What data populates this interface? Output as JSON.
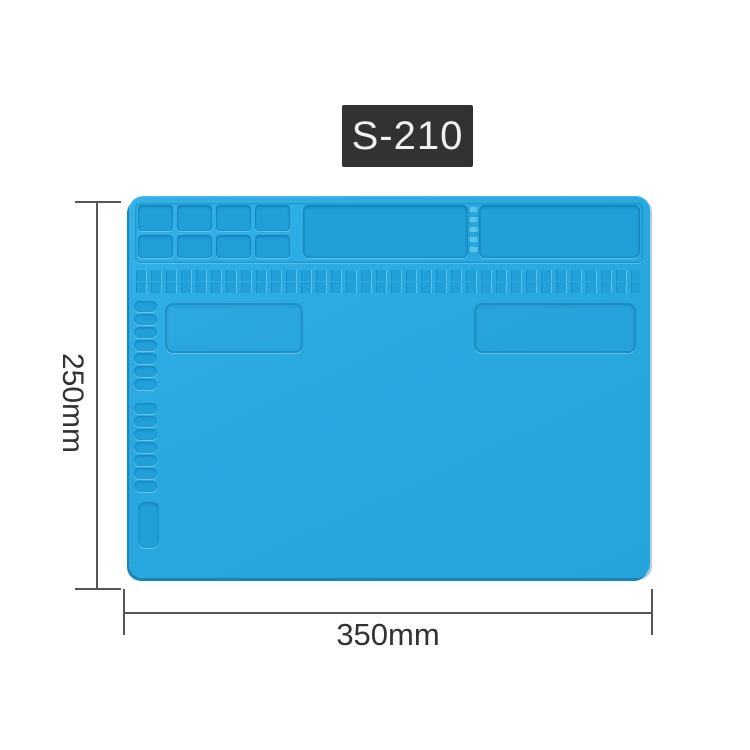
{
  "product": {
    "model_label": "S-210"
  },
  "dimensions": {
    "height_label": "250mm",
    "width_label": "350mm"
  },
  "colors": {
    "mat-surface": "#29a8e0",
    "mat-surface-light": "#32b0e7",
    "mat-cell": "#21a0d8",
    "mat-groove": "#1590c9",
    "mat-highlight": "#58c3ed",
    "mat-edge": "#1a85ba",
    "badge-bg": "#333134",
    "badge-text": "#f1eff1",
    "dim-line": "#55565a",
    "dim-text": "#303234"
  }
}
